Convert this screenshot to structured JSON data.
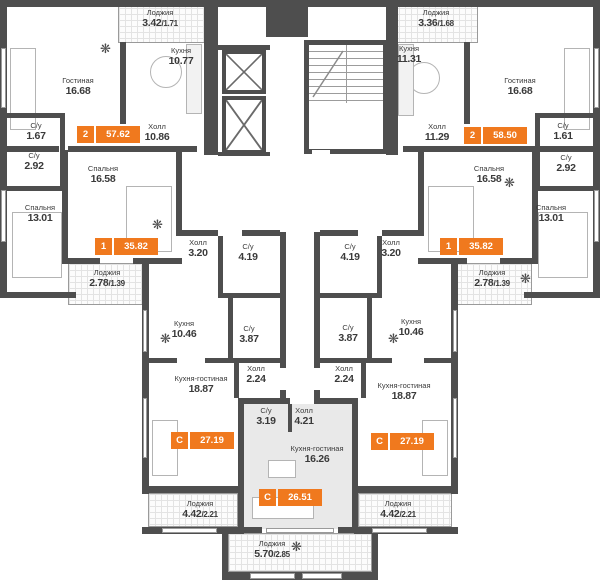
{
  "plan": {
    "colors": {
      "accent": "#F0791E",
      "wall": "#4E4E4E",
      "studio_fill": "#E9E9E9",
      "loggia_grid": "#E3E3E3"
    },
    "rooms": {
      "loggia_tl": {
        "name": "Лоджия",
        "area": "3.42",
        "ratio": "/1.71"
      },
      "loggia_tr": {
        "name": "Лоджия",
        "area": "3.36",
        "ratio": "/1.68"
      },
      "kitchen_tl": {
        "name": "Кухня",
        "area": "10.77"
      },
      "kitchen_tr": {
        "name": "Кухня",
        "area": "11.31"
      },
      "living_tl": {
        "name": "Гостиная",
        "area": "16.68"
      },
      "living_tr": {
        "name": "Гостиная",
        "area": "16.68"
      },
      "wc1_tl": {
        "name": "С/у",
        "area": "1.67"
      },
      "wc1_tr": {
        "name": "С/у",
        "area": "1.61"
      },
      "hall_tl": {
        "name": "Холл",
        "area": "10.86"
      },
      "hall_tr": {
        "name": "Холл",
        "area": "11.29"
      },
      "wc2_tl": {
        "name": "С/у",
        "area": "2.92"
      },
      "wc2_tr": {
        "name": "С/у",
        "area": "2.92"
      },
      "bed1_l": {
        "name": "Спальня",
        "area": "16.58"
      },
      "bed1_r": {
        "name": "Спальня",
        "area": "16.58"
      },
      "bed2_l": {
        "name": "Спальня",
        "area": "13.01"
      },
      "bed2_r": {
        "name": "Спальня",
        "area": "13.01"
      },
      "hall1_l": {
        "name": "Холл",
        "area": "3.20"
      },
      "hall1_r": {
        "name": "Холл",
        "area": "3.20"
      },
      "wc3_l": {
        "name": "С/у",
        "area": "4.19"
      },
      "wc3_r": {
        "name": "С/у",
        "area": "4.19"
      },
      "loggia_ml": {
        "name": "Лоджия",
        "area": "2.78",
        "ratio": "/1.39"
      },
      "loggia_mr": {
        "name": "Лоджия",
        "area": "2.78",
        "ratio": "/1.39"
      },
      "kitchen_sl": {
        "name": "Кухня",
        "area": "10.46"
      },
      "kitchen_sr": {
        "name": "Кухня",
        "area": "10.46"
      },
      "wc_sl": {
        "name": "С/у",
        "area": "3.87"
      },
      "wc_sr": {
        "name": "С/у",
        "area": "3.87"
      },
      "hall_sl": {
        "name": "Холл",
        "area": "2.24"
      },
      "hall_sr": {
        "name": "Холл",
        "area": "2.24"
      },
      "kl_sl": {
        "name": "Кухня-гостиная",
        "area": "18.87"
      },
      "kl_sr": {
        "name": "Кухня-гостиная",
        "area": "18.87"
      },
      "wc_c": {
        "name": "С/у",
        "area": "3.19"
      },
      "hall_c": {
        "name": "Холл",
        "area": "4.21"
      },
      "kl_c": {
        "name": "Кухня-гостиная",
        "area": "16.26"
      },
      "loggia_bl": {
        "name": "Лоджия",
        "area": "4.42",
        "ratio": "/2.21"
      },
      "loggia_br": {
        "name": "Лоджия",
        "area": "4.42",
        "ratio": "/2.21"
      },
      "loggia_bc": {
        "name": "Лоджия",
        "area": "5.70",
        "ratio": "/2.85"
      }
    },
    "badges": {
      "apt2_left": {
        "unit": "2",
        "area": "57.62"
      },
      "apt2_right": {
        "unit": "2",
        "area": "58.50"
      },
      "apt1_left": {
        "unit": "1",
        "area": "35.82"
      },
      "apt1_right": {
        "unit": "1",
        "area": "35.82"
      },
      "studio_left": {
        "unit": "С",
        "area": "27.19"
      },
      "studio_right": {
        "unit": "С",
        "area": "27.19"
      },
      "studio_center": {
        "unit": "С",
        "area": "26.51"
      }
    }
  }
}
